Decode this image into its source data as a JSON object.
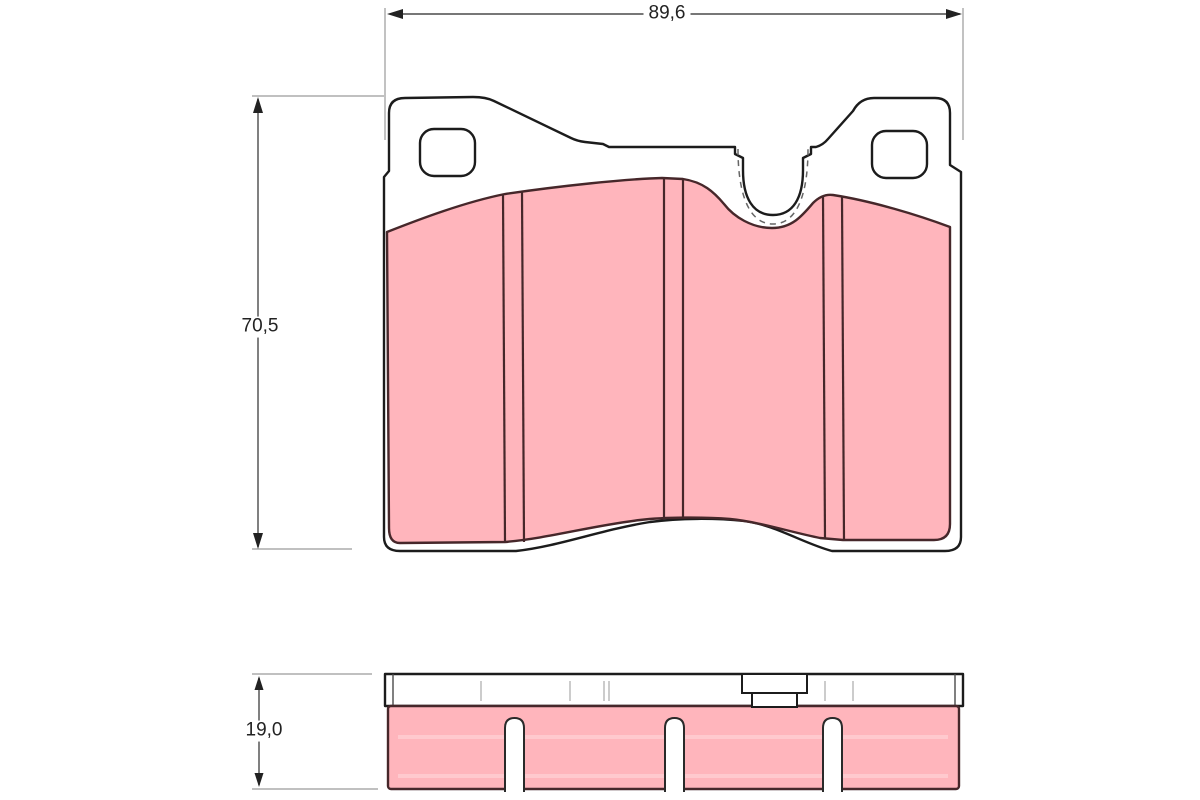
{
  "diagram": {
    "type": "brake-pad-technical-drawing",
    "views": {
      "front_view": "brake pad front view with backplate, mounting holes, wear notch and friction material",
      "side_view": "brake pad edge view with backplate strip, retaining tab and slotted friction material"
    },
    "dimensions": {
      "width": {
        "label": "89,6"
      },
      "height": {
        "label": "70,5"
      },
      "thickness": {
        "label": "19,0"
      }
    },
    "colors": {
      "friction": "#ffb5bc",
      "friction_outline": "#46272a",
      "plate_outline": "#1c1c1c",
      "dimension_line": "#4a4a4a",
      "extension_line": "#9a9a9a",
      "label_text": "#222222",
      "background": "#ffffff"
    }
  }
}
